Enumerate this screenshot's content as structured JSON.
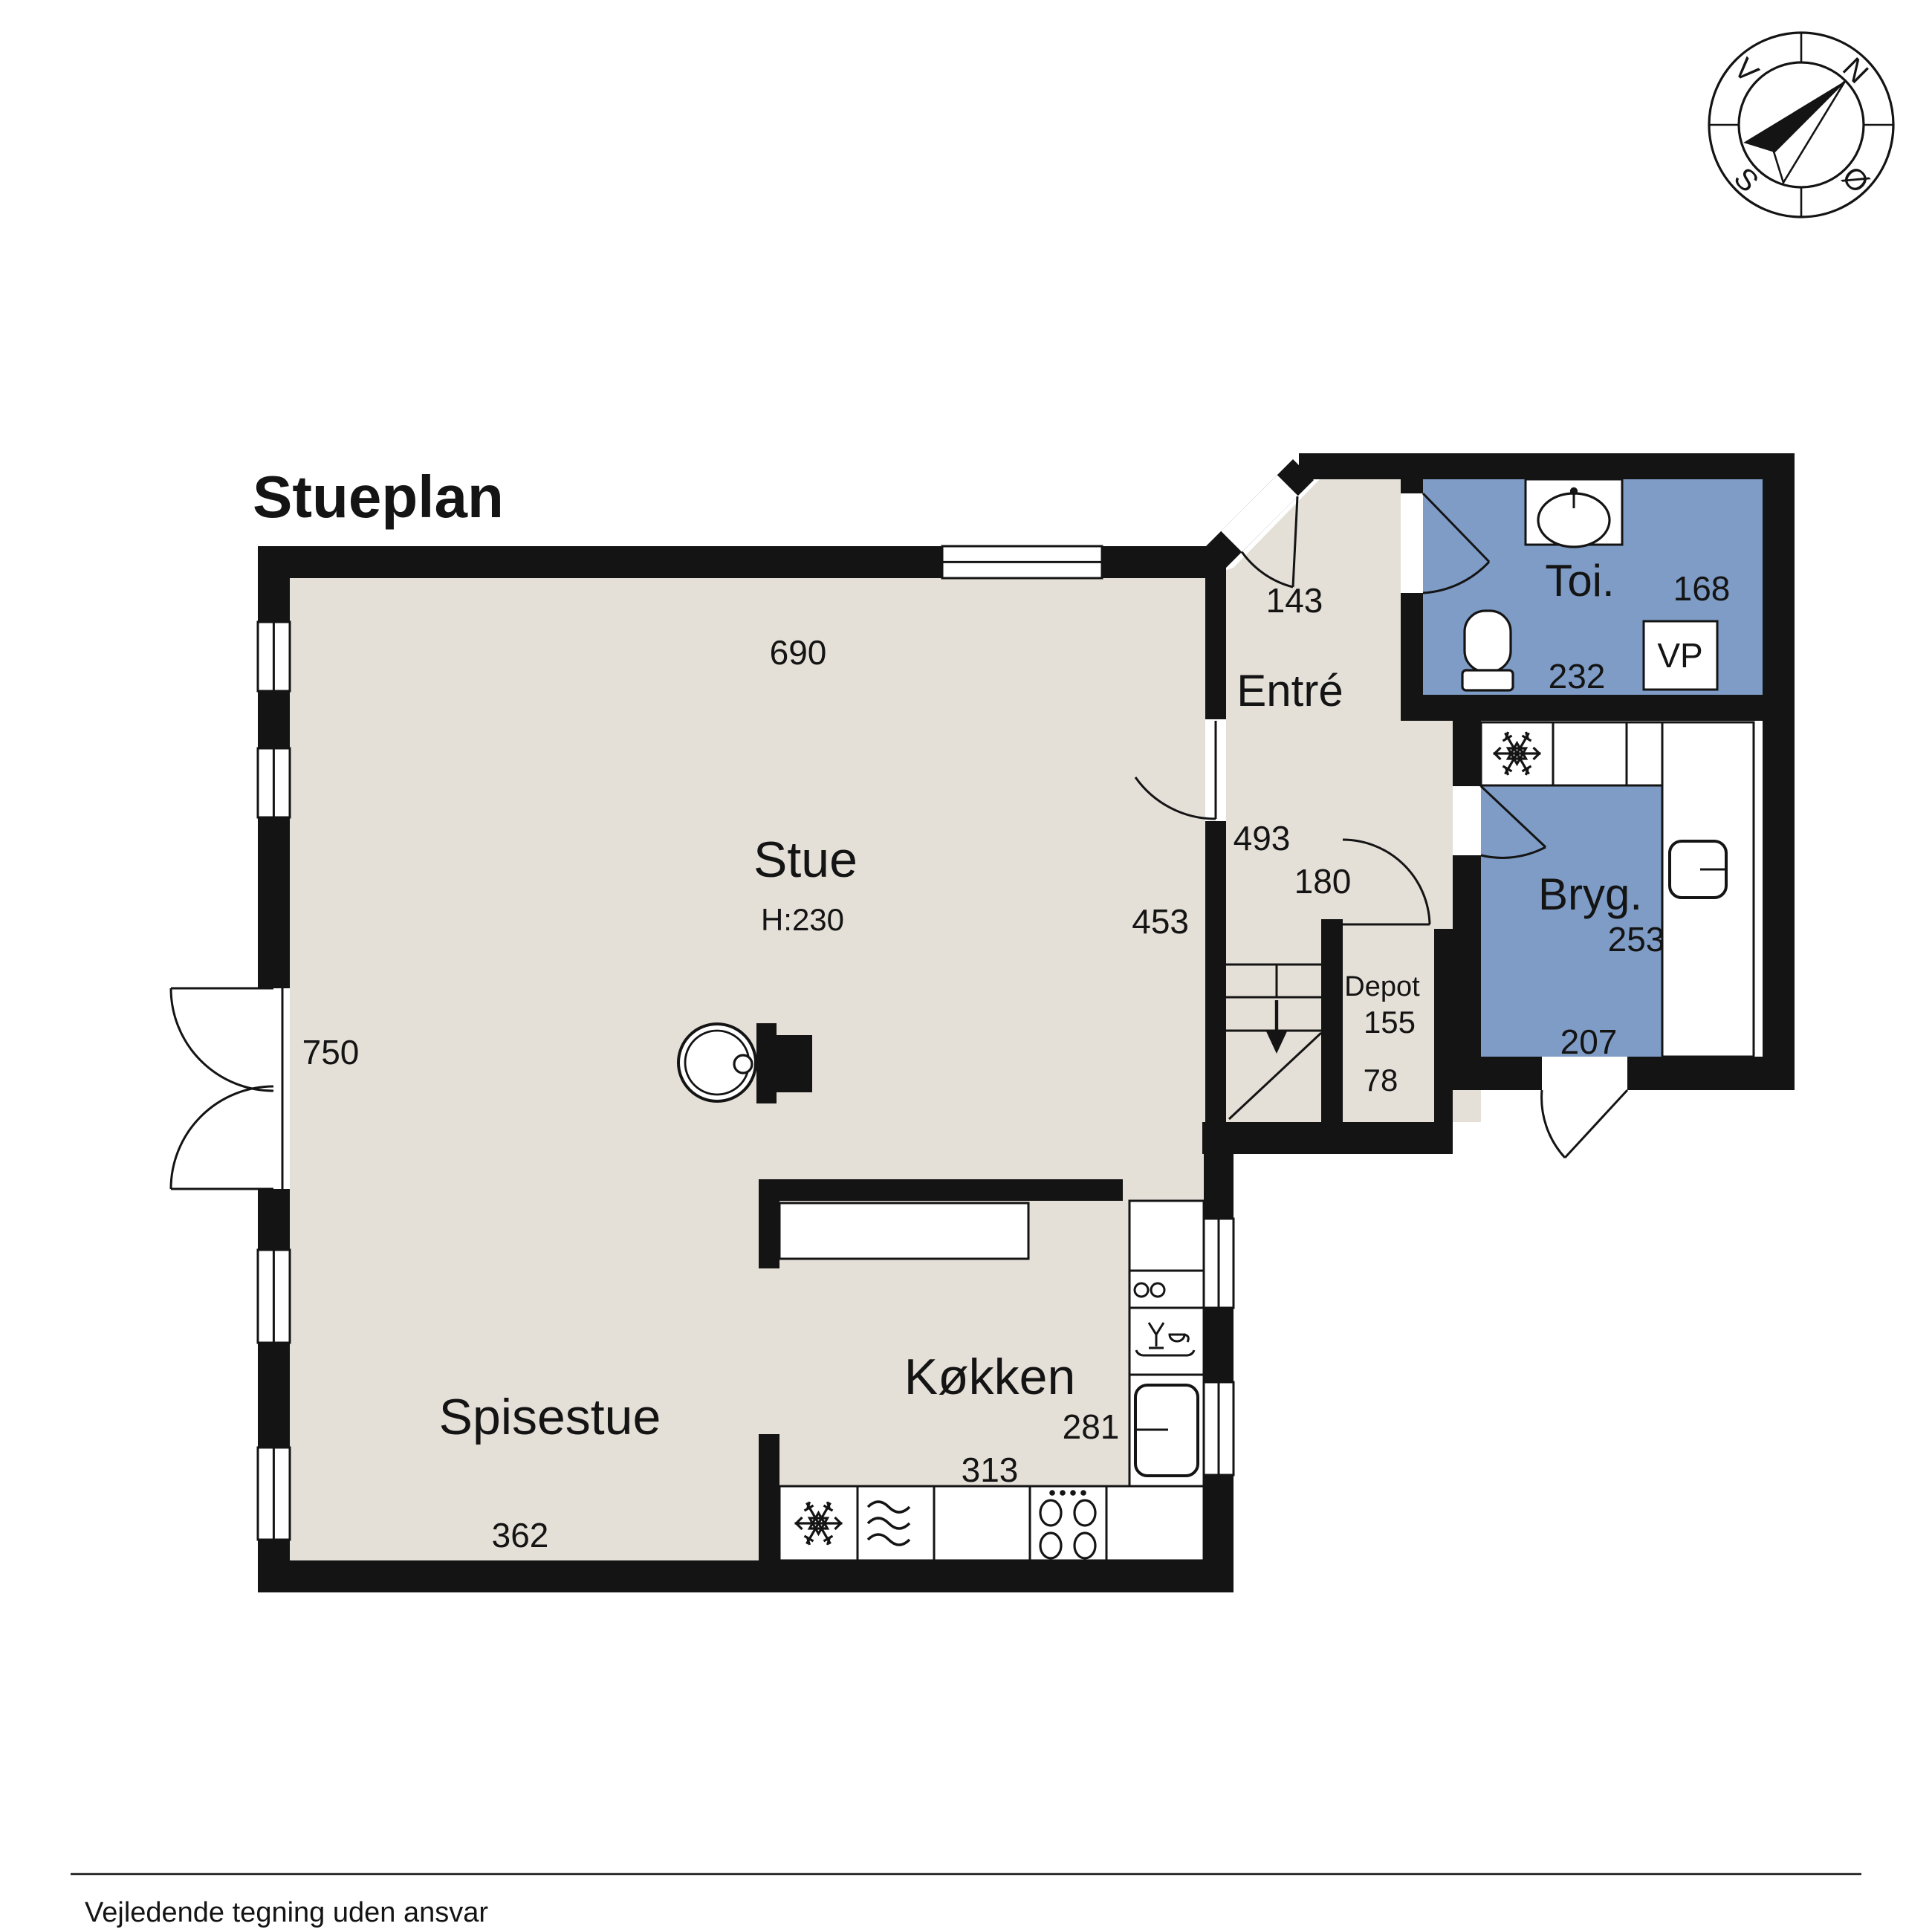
{
  "title": "Stueplan",
  "footer": {
    "disclaimer": "Vejledende tegning uden ansvar"
  },
  "compass": {
    "north": "N",
    "east": "Ø",
    "south": "S",
    "west": "V"
  },
  "colors": {
    "wall": "#141414",
    "floor": "#e4dfd7",
    "wet_room_blue": "#7e9cc5",
    "background": "#ffffff"
  },
  "rooms": {
    "stue": {
      "label": "Stue",
      "height": "H:230",
      "dim_top": "690",
      "dim_left": "750",
      "dim_right": "453"
    },
    "spisestue": {
      "label": "Spisestue",
      "dim_bottom": "362"
    },
    "kokken": {
      "label": "Køkken",
      "dim_right": "281",
      "dim_bottom": "313"
    },
    "entre": {
      "label": "Entré",
      "dim_top": "143",
      "dim_left": "493",
      "dim_stair": "180"
    },
    "toilet": {
      "label": "Toi.",
      "dim_right": "168",
      "dim_bottom": "232",
      "vp": "VP"
    },
    "bryggers": {
      "label": "Bryg.",
      "dim_right": "253",
      "dim_bottom": "207"
    },
    "depot": {
      "label": "Depot",
      "dim": "155",
      "dim_bottom": "78"
    }
  }
}
